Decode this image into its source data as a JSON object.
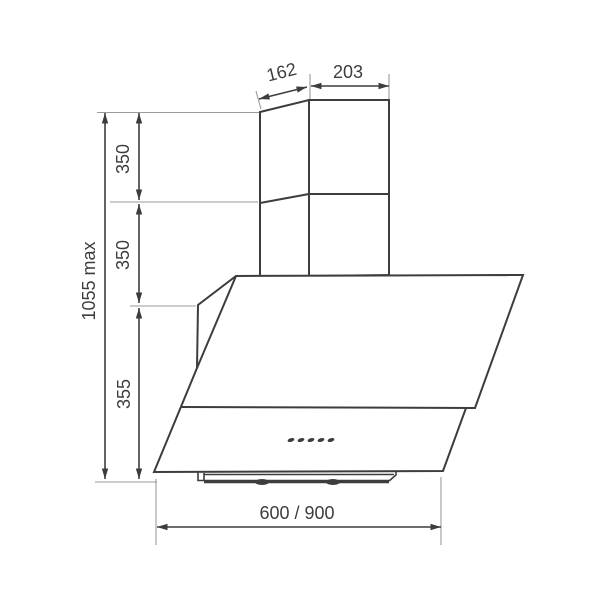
{
  "drawing": {
    "type": "cooker-hood dimension drawing",
    "labels": {
      "duct_depth": "162",
      "duct_width": "203",
      "upper_duct_height": "350",
      "lower_duct_height": "350",
      "body_height": "355",
      "total_height": "1055 max",
      "body_width": "600 / 900"
    },
    "control_buttons_count": 5,
    "colors": {
      "line": "#3d3d3d",
      "extension_line": "#9a9a9a",
      "background": "#ffffff"
    }
  }
}
